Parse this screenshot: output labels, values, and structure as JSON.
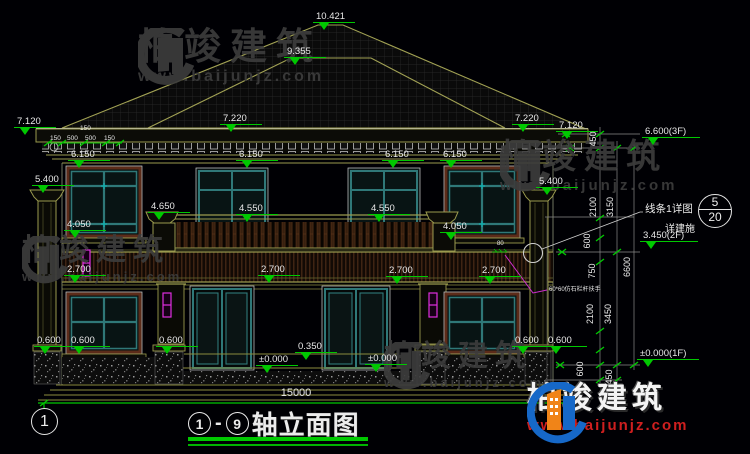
{
  "colors": {
    "green": "#00c800",
    "olive": "#9a9a4e",
    "teal": "#2f7878",
    "maroon": "#5c2b19",
    "magenta": "#e02ee0",
    "white_text": "#e8e8e8",
    "watermark_gray": "#3c3c3c",
    "logo_blue": "#1668c8",
    "logo_orange": "#f08418",
    "logo_red": "#cf1f1f"
  },
  "title": {
    "axis_start": "1",
    "dash": "-",
    "axis_end": "9",
    "name": "轴立面图"
  },
  "axis_bubble": "1",
  "detail_callout": {
    "label": "线条1详图",
    "ref_top": "5",
    "ref_bottom": "20",
    "note": "详建施"
  },
  "overall_dim": {
    "v": "15000",
    "x": 296,
    "y": 396
  },
  "railing_note": {
    "text": "60*60仿石栏杆扶手",
    "x": 549,
    "y": 291,
    "tick": "80",
    "tick_x": 497,
    "tick_y": 245
  },
  "levels": [
    {
      "v": "10.421",
      "x": 316,
      "y": 10
    },
    {
      "v": "9.355",
      "x": 287,
      "y": 45
    },
    {
      "v": "7.120",
      "x": 17,
      "y": 115
    },
    {
      "v": "7.220",
      "x": 223,
      "y": 112
    },
    {
      "v": "7.220",
      "x": 515,
      "y": 112
    },
    {
      "v": "7.120",
      "x": 559,
      "y": 119
    },
    {
      "v": "6.150",
      "x": 71,
      "y": 148
    },
    {
      "v": "6.150",
      "x": 239,
      "y": 148
    },
    {
      "v": "6.150",
      "x": 385,
      "y": 148
    },
    {
      "v": "6.150",
      "x": 443,
      "y": 148
    },
    {
      "v": "5.400",
      "x": 35,
      "y": 173
    },
    {
      "v": "5.400",
      "x": 539,
      "y": 175
    },
    {
      "v": "4.650",
      "x": 151,
      "y": 200
    },
    {
      "v": "4.550",
      "x": 239,
      "y": 202
    },
    {
      "v": "4.550",
      "x": 371,
      "y": 202
    },
    {
      "v": "4.050",
      "x": 67,
      "y": 218
    },
    {
      "v": "4.050",
      "x": 443,
      "y": 220
    },
    {
      "v": "2.700",
      "x": 67,
      "y": 263
    },
    {
      "v": "2.700",
      "x": 261,
      "y": 263
    },
    {
      "v": "2.700",
      "x": 389,
      "y": 264
    },
    {
      "v": "2.700",
      "x": 482,
      "y": 264
    },
    {
      "v": "0.600",
      "x": 37,
      "y": 334
    },
    {
      "v": "0.600",
      "x": 71,
      "y": 334
    },
    {
      "v": "0.600",
      "x": 159,
      "y": 334
    },
    {
      "v": "0.600",
      "x": 515,
      "y": 334
    },
    {
      "v": "0.600",
      "x": 548,
      "y": 334
    },
    {
      "v": "0.350",
      "x": 298,
      "y": 340
    },
    {
      "v": "±0.000",
      "x": 259,
      "y": 353
    },
    {
      "v": "±0.000",
      "x": 368,
      "y": 352
    },
    {
      "v": "6.600(3F)",
      "x": 645,
      "y": 125,
      "w": 58
    },
    {
      "v": "3.450(2F)",
      "x": 643,
      "y": 229,
      "w": 58
    },
    {
      "v": "±0.000(1F)",
      "x": 640,
      "y": 347,
      "w": 62
    }
  ],
  "right_dims": [
    {
      "v": "450",
      "x": 596,
      "y": 139
    },
    {
      "v": "2100",
      "x": 596,
      "y": 207
    },
    {
      "v": "600",
      "x": 590,
      "y": 241
    },
    {
      "v": "750",
      "x": 595,
      "y": 271
    },
    {
      "v": "2100",
      "x": 593,
      "y": 314
    },
    {
      "v": "600",
      "x": 583,
      "y": 369
    },
    {
      "v": "3150",
      "x": 613,
      "y": 207
    },
    {
      "v": "3450",
      "x": 611,
      "y": 314
    },
    {
      "v": "450",
      "x": 612,
      "y": 377
    },
    {
      "v": "6600",
      "x": 630,
      "y": 267
    }
  ],
  "eave_dims": {
    "upper": {
      "v": "150",
      "x": 80,
      "y": 130
    },
    "row_y": 140,
    "row": [
      {
        "v": "150",
        "x": 50
      },
      {
        "v": "500",
        "x": 67
      },
      {
        "v": "500",
        "x": 85
      },
      {
        "v": "150",
        "x": 104
      }
    ]
  },
  "watermark": {
    "brand": "柏竣建筑",
    "url": "www.baijunjz.com"
  },
  "logo": {
    "brand": "柏竣建筑",
    "url": "www.baijunjz.com"
  }
}
